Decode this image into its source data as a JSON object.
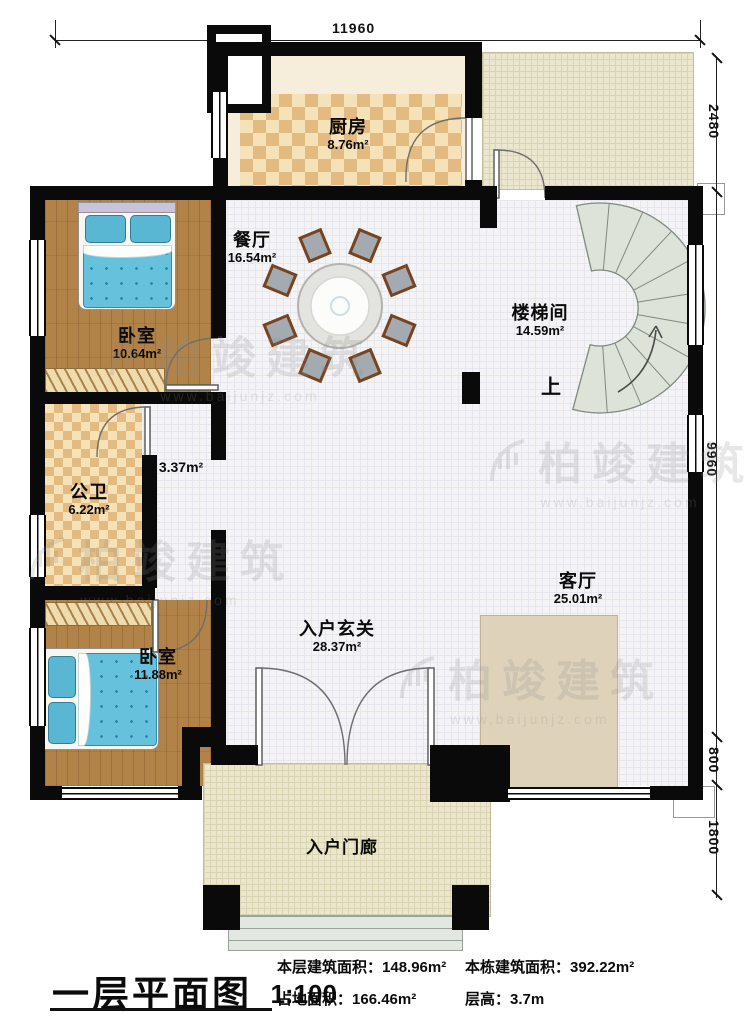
{
  "plan": {
    "title": "一层平面图",
    "scale": "1:100"
  },
  "stats": {
    "floor_area_label": "本层建筑面积：",
    "floor_area_value": "148.96m²",
    "footprint_label": "占地面积：",
    "footprint_value": "166.46m²",
    "total_area_label": "本栋建筑面积：",
    "total_area_value": "392.22m²",
    "story_height_label": "层高：",
    "story_height_value": "3.7m"
  },
  "dimensions": {
    "top_width": "11960",
    "right_segments": [
      "2480",
      "9960",
      "800",
      "1800"
    ]
  },
  "rooms": {
    "kitchen": {
      "name": "厨房",
      "area": "8.76m²"
    },
    "dining": {
      "name": "餐厅",
      "area": "16.54m²"
    },
    "bedroom1": {
      "name": "卧室",
      "area": "10.64m²"
    },
    "stairwell": {
      "name": "楼梯间",
      "area": "14.59m²",
      "direction": "上"
    },
    "bathroom": {
      "name": "公卫",
      "area": "6.22m²"
    },
    "corridor": {
      "area": "3.37m²"
    },
    "bedroom2": {
      "name": "卧室",
      "area": "11.88m²"
    },
    "living": {
      "name": "客厅",
      "area": "25.01m²"
    },
    "foyer": {
      "name": "入户玄关",
      "area": "28.37m²"
    },
    "porch": {
      "name": "入户门廊"
    }
  },
  "watermark": {
    "brand": "柏竣建筑",
    "url": "www.baijunjz.com"
  },
  "colors": {
    "wall": "#0a0a0a",
    "wood_floor": "#b28349",
    "tile": "#e3bb80",
    "bedding": "#66c2dc",
    "accent_red": "#7c2d1e",
    "stair_tread": "#dde3d8",
    "outdoor": "#ebe6ce"
  }
}
